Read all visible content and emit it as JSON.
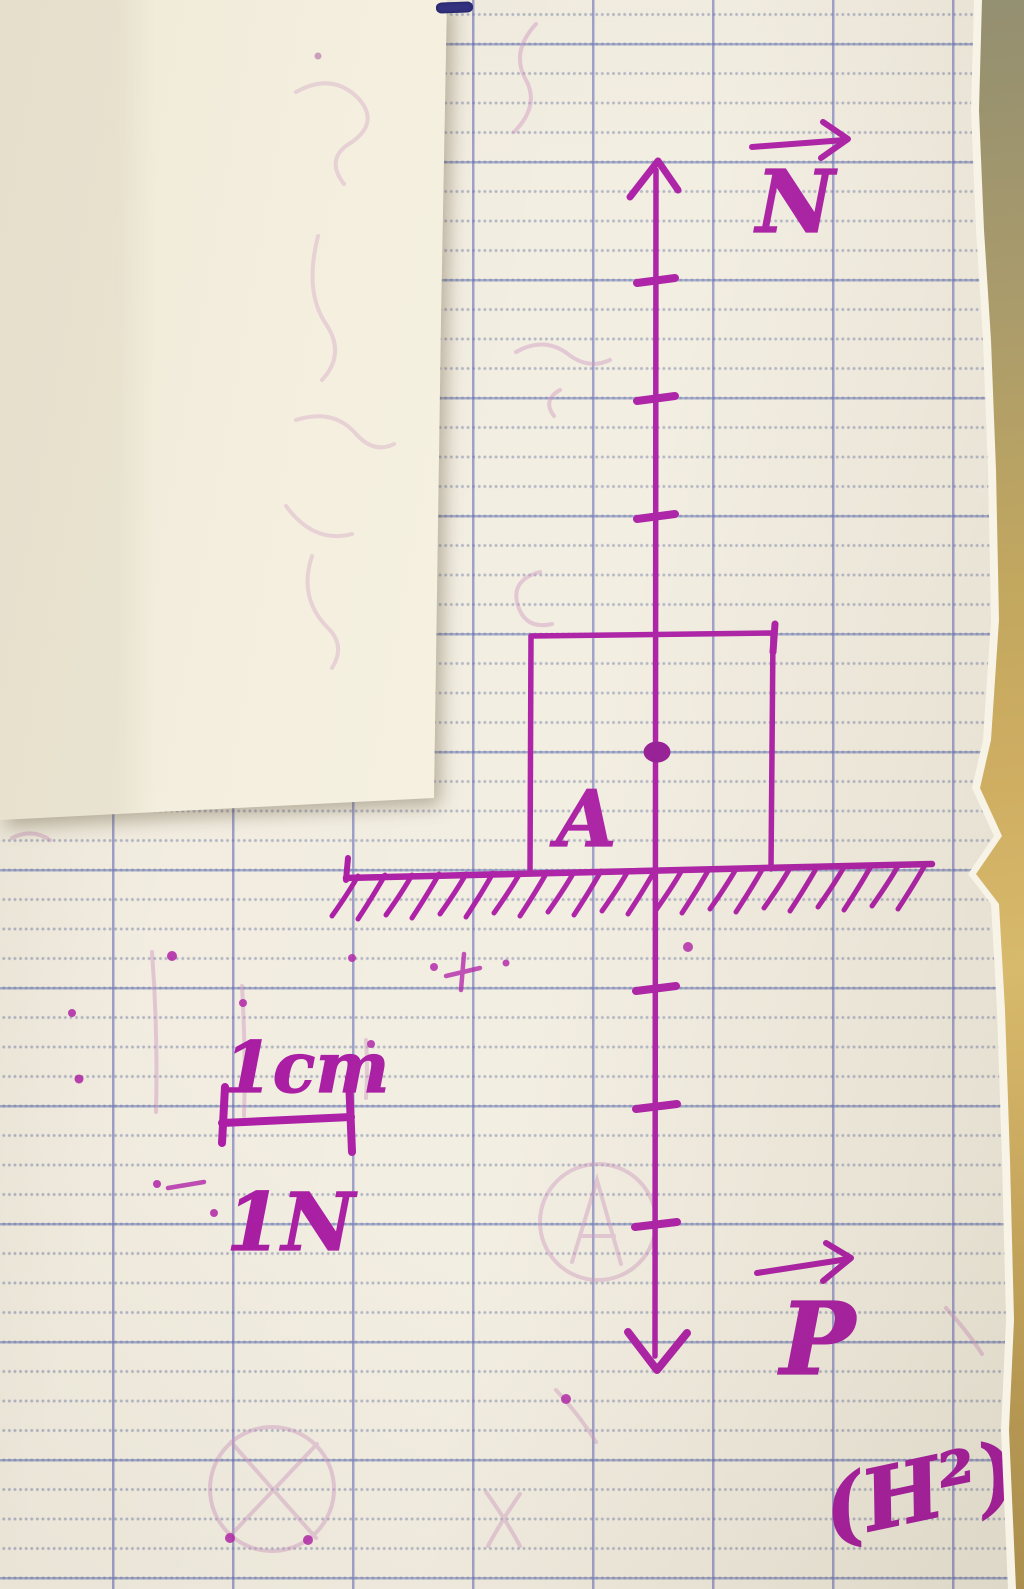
{
  "diagram": {
    "title": "Free-body force diagram: box resting on the ground",
    "labels": {
      "normal_force": "N",
      "weight_force": "P",
      "point": "A",
      "scale_length": "1cm",
      "scale_force": "1N",
      "page_ref": "(H²)"
    },
    "forces": [
      {
        "label": "N",
        "direction": "up",
        "applied_at": "A"
      },
      {
        "label": "P",
        "direction": "down",
        "applied_at": "A"
      }
    ],
    "scale": "1cm = 1N",
    "ink_color": "#a30e9d"
  },
  "paper": {
    "type": "seyes-grid-notebook",
    "paper_color": "#f1ecdf",
    "horizontal_line_color": "#6876b2",
    "vertical_line_color": "#6066b4",
    "table_color": "#c9ab62"
  }
}
